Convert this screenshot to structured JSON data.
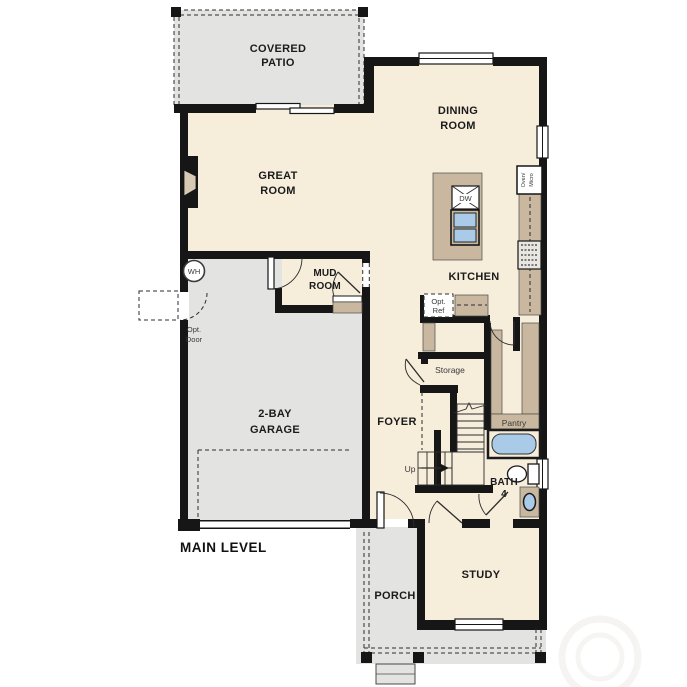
{
  "plan_title": "MAIN LEVEL",
  "rooms": {
    "covered_patio": {
      "line1": "COVERED",
      "line2": "PATIO"
    },
    "dining_room": {
      "line1": "DINING",
      "line2": "ROOM"
    },
    "great_room": {
      "line1": "GREAT",
      "line2": "ROOM"
    },
    "mud_room": {
      "line1": "MUD",
      "line2": "ROOM"
    },
    "kitchen": {
      "label": "KITCHEN"
    },
    "garage": {
      "line1": "2-BAY",
      "line2": "GARAGE"
    },
    "foyer": {
      "label": "FOYER"
    },
    "storage": {
      "label": "Storage"
    },
    "pantry": {
      "label": "Pantry"
    },
    "bath": {
      "line1": "BATH",
      "line2": "4"
    },
    "study": {
      "label": "STUDY"
    },
    "porch": {
      "label": "PORCH"
    }
  },
  "annotations": {
    "main_level": "MAIN LEVEL",
    "up": "Up",
    "opt_door": {
      "line1": "Opt.",
      "line2": "Door"
    },
    "opt_ref": {
      "line1": "Opt.",
      "line2": "Ref"
    },
    "water_heater": "WH",
    "dishwasher": "DW",
    "oven_micro": {
      "line1": "Oven/",
      "line2": "Micro"
    }
  },
  "colors": {
    "wall": "#161616",
    "floor": "#f6eddb",
    "exterior_concrete": "#e3e3e1",
    "casework_tan": "#c9b89f",
    "fixture_blue": "#a9cbe7"
  }
}
